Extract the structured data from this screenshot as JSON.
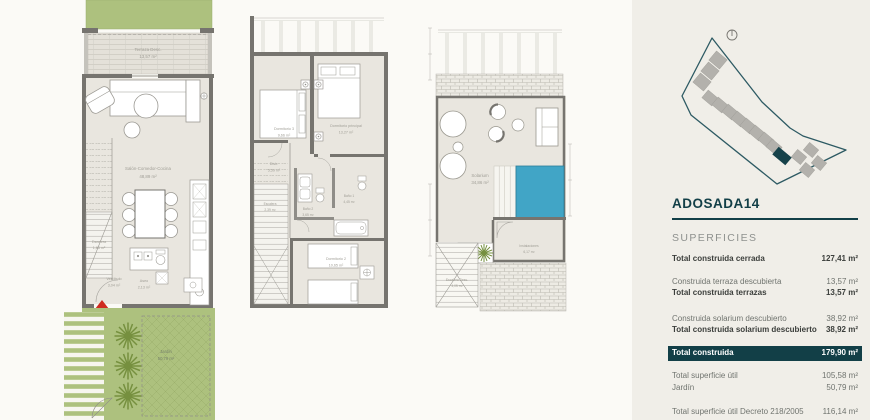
{
  "colors": {
    "teal": "#123f47",
    "garden_green": "#adc17e",
    "pool_blue": "#41a5c6",
    "entrance_red": "#cf2b1f",
    "floor_beige": "#e9e6df",
    "panel_beige": "#f0eee8"
  },
  "plan_ground": {
    "terrace_label": "Terraza Desc.",
    "terrace_area": "13,57 m²",
    "living_label": "Salón-Comedor-Cocina",
    "living_area": "48,89 m²",
    "stairs_label": "Escalera",
    "stairs_area": "1,86 m²",
    "hall_label": "Vestíbulo",
    "hall_area": "3,04 m²",
    "toilet_label": "Aseo",
    "toilet_area": "2,13 m²",
    "garden_label": "Jardín",
    "garden_area": "50,79 m²"
  },
  "plan_first": {
    "bedroom3_label": "Dormitorio 3",
    "bedroom3_area": "9,66 m²",
    "master_label": "Dormitorio principal",
    "master_area": "13,27 m²",
    "distr_label": "Distr.",
    "distr_area": "5,59 m²",
    "stairs_label": "Escalera",
    "stairs_area": "2,39 m²",
    "bath2_label": "Baño 2",
    "bath2_area": "3,65 m²",
    "bath1_label": "Baño 1",
    "bath1_area": "4,45 m²",
    "bedroom2_label": "Dormitorio 2",
    "bedroom2_area": "10,65 m²"
  },
  "plan_solarium": {
    "solarium_label": "Solarium",
    "solarium_area": "34,86 m²",
    "instal_label": "Instalaciones",
    "instal_area": "6,17 m²",
    "stairs_label": "Escalera Desc.",
    "stairs_area": "4,05 m²"
  },
  "panel": {
    "title": "ADOSADA14",
    "section": "SUPERFICIES",
    "rows": [
      {
        "label": "Total construida cerrada",
        "value": "127,41 m²"
      },
      {
        "label": "Construida terraza descubierta",
        "value": "13,57 m²"
      },
      {
        "label": "Total construida terrazas",
        "value": "13,57 m²"
      },
      {
        "label": "Construida solarium descubierto",
        "value": "38,92 m²"
      },
      {
        "label": "Total construida solarium descubierto",
        "value": "38,92 m²"
      },
      {
        "label": "Total construida",
        "value": "179,90 m²"
      },
      {
        "label": "Total superficie útil",
        "value": "105,58 m²"
      },
      {
        "label": "Jardín",
        "value": "50,79 m²"
      },
      {
        "label": "Total superficie útil Decreto 218/2005",
        "value": "116,14 m²"
      },
      {
        "label": "Total superficie construida Decreto 218/2005",
        "value": "146,68 m²"
      }
    ]
  }
}
